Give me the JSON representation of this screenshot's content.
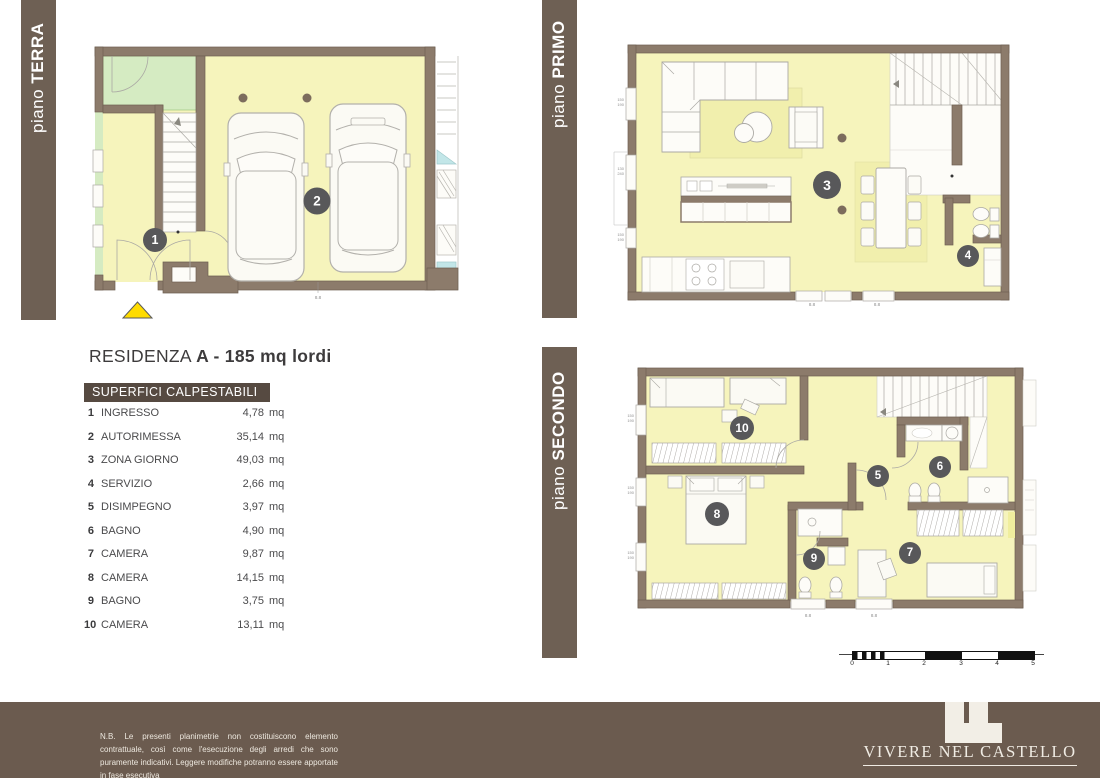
{
  "floor_labels": {
    "terra": {
      "prefix": "piano ",
      "name": "TERRA"
    },
    "primo": {
      "prefix": "piano ",
      "name": "PRIMO"
    },
    "secondo": {
      "prefix": "piano ",
      "name": "SECONDO"
    }
  },
  "residence": {
    "title_regular": "RESIDENZA",
    "title_bold": "A - 185 mq lordi"
  },
  "table": {
    "header": "SUPERFICI CALPESTABILI",
    "unit": "mq",
    "rows": [
      {
        "n": "1",
        "name": "INGRESSO",
        "value": "4,78"
      },
      {
        "n": "2",
        "name": "AUTORIMESSA",
        "value": "35,14"
      },
      {
        "n": "3",
        "name": "ZONA GIORNO",
        "value": "49,03"
      },
      {
        "n": "4",
        "name": "SERVIZIO",
        "value": "2,66"
      },
      {
        "n": "5",
        "name": "DISIMPEGNO",
        "value": "3,97"
      },
      {
        "n": "6",
        "name": "BAGNO",
        "value": "4,90"
      },
      {
        "n": "7",
        "name": "CAMERA",
        "value": "9,87"
      },
      {
        "n": "8",
        "name": "CAMERA",
        "value": "14,15"
      },
      {
        "n": "9",
        "name": "BAGNO",
        "value": "3,75"
      },
      {
        "n": "10",
        "name": "CAMERA",
        "value": "13,11"
      }
    ]
  },
  "plan_numbers": {
    "n1": "1",
    "n2": "2",
    "n3": "3",
    "n4": "4",
    "n5": "5",
    "n6": "6",
    "n7": "7",
    "n8": "8",
    "n9": "9",
    "n10": "10"
  },
  "dims": {
    "d150": "150",
    "d190": "190",
    "d130": "130",
    "d240": "240",
    "d88": "8.8"
  },
  "scale_bar": {
    "labels": [
      "0",
      "1",
      "2",
      "3",
      "4",
      "5"
    ]
  },
  "footer": {
    "disclaimer": "N.B. Le presenti planimetrie non costituiscono elemento contrattuale, così come l'esecuzione degli arredi che sono puramente indicativi. Leggere modifiche potranno essere apportate in fase esecutiva",
    "brand": "VIVERE NEL CASTELLO"
  },
  "colors": {
    "bar_brown": "#6E6054",
    "header_brown": "#564A41",
    "footer_brown": "#6B5B4F",
    "wall_brown": "#8C7B6B",
    "wall_edge": "#6E6052",
    "floor_yellow": "#F6F4BC",
    "rug_yellow": "#F1EFAD",
    "green": "#D5EBC2",
    "cyan": "#C2E6E8",
    "circle_gray": "#58585A",
    "dot_brown": "#7C6C5D",
    "triangle_yellow": "#FFDC00"
  }
}
